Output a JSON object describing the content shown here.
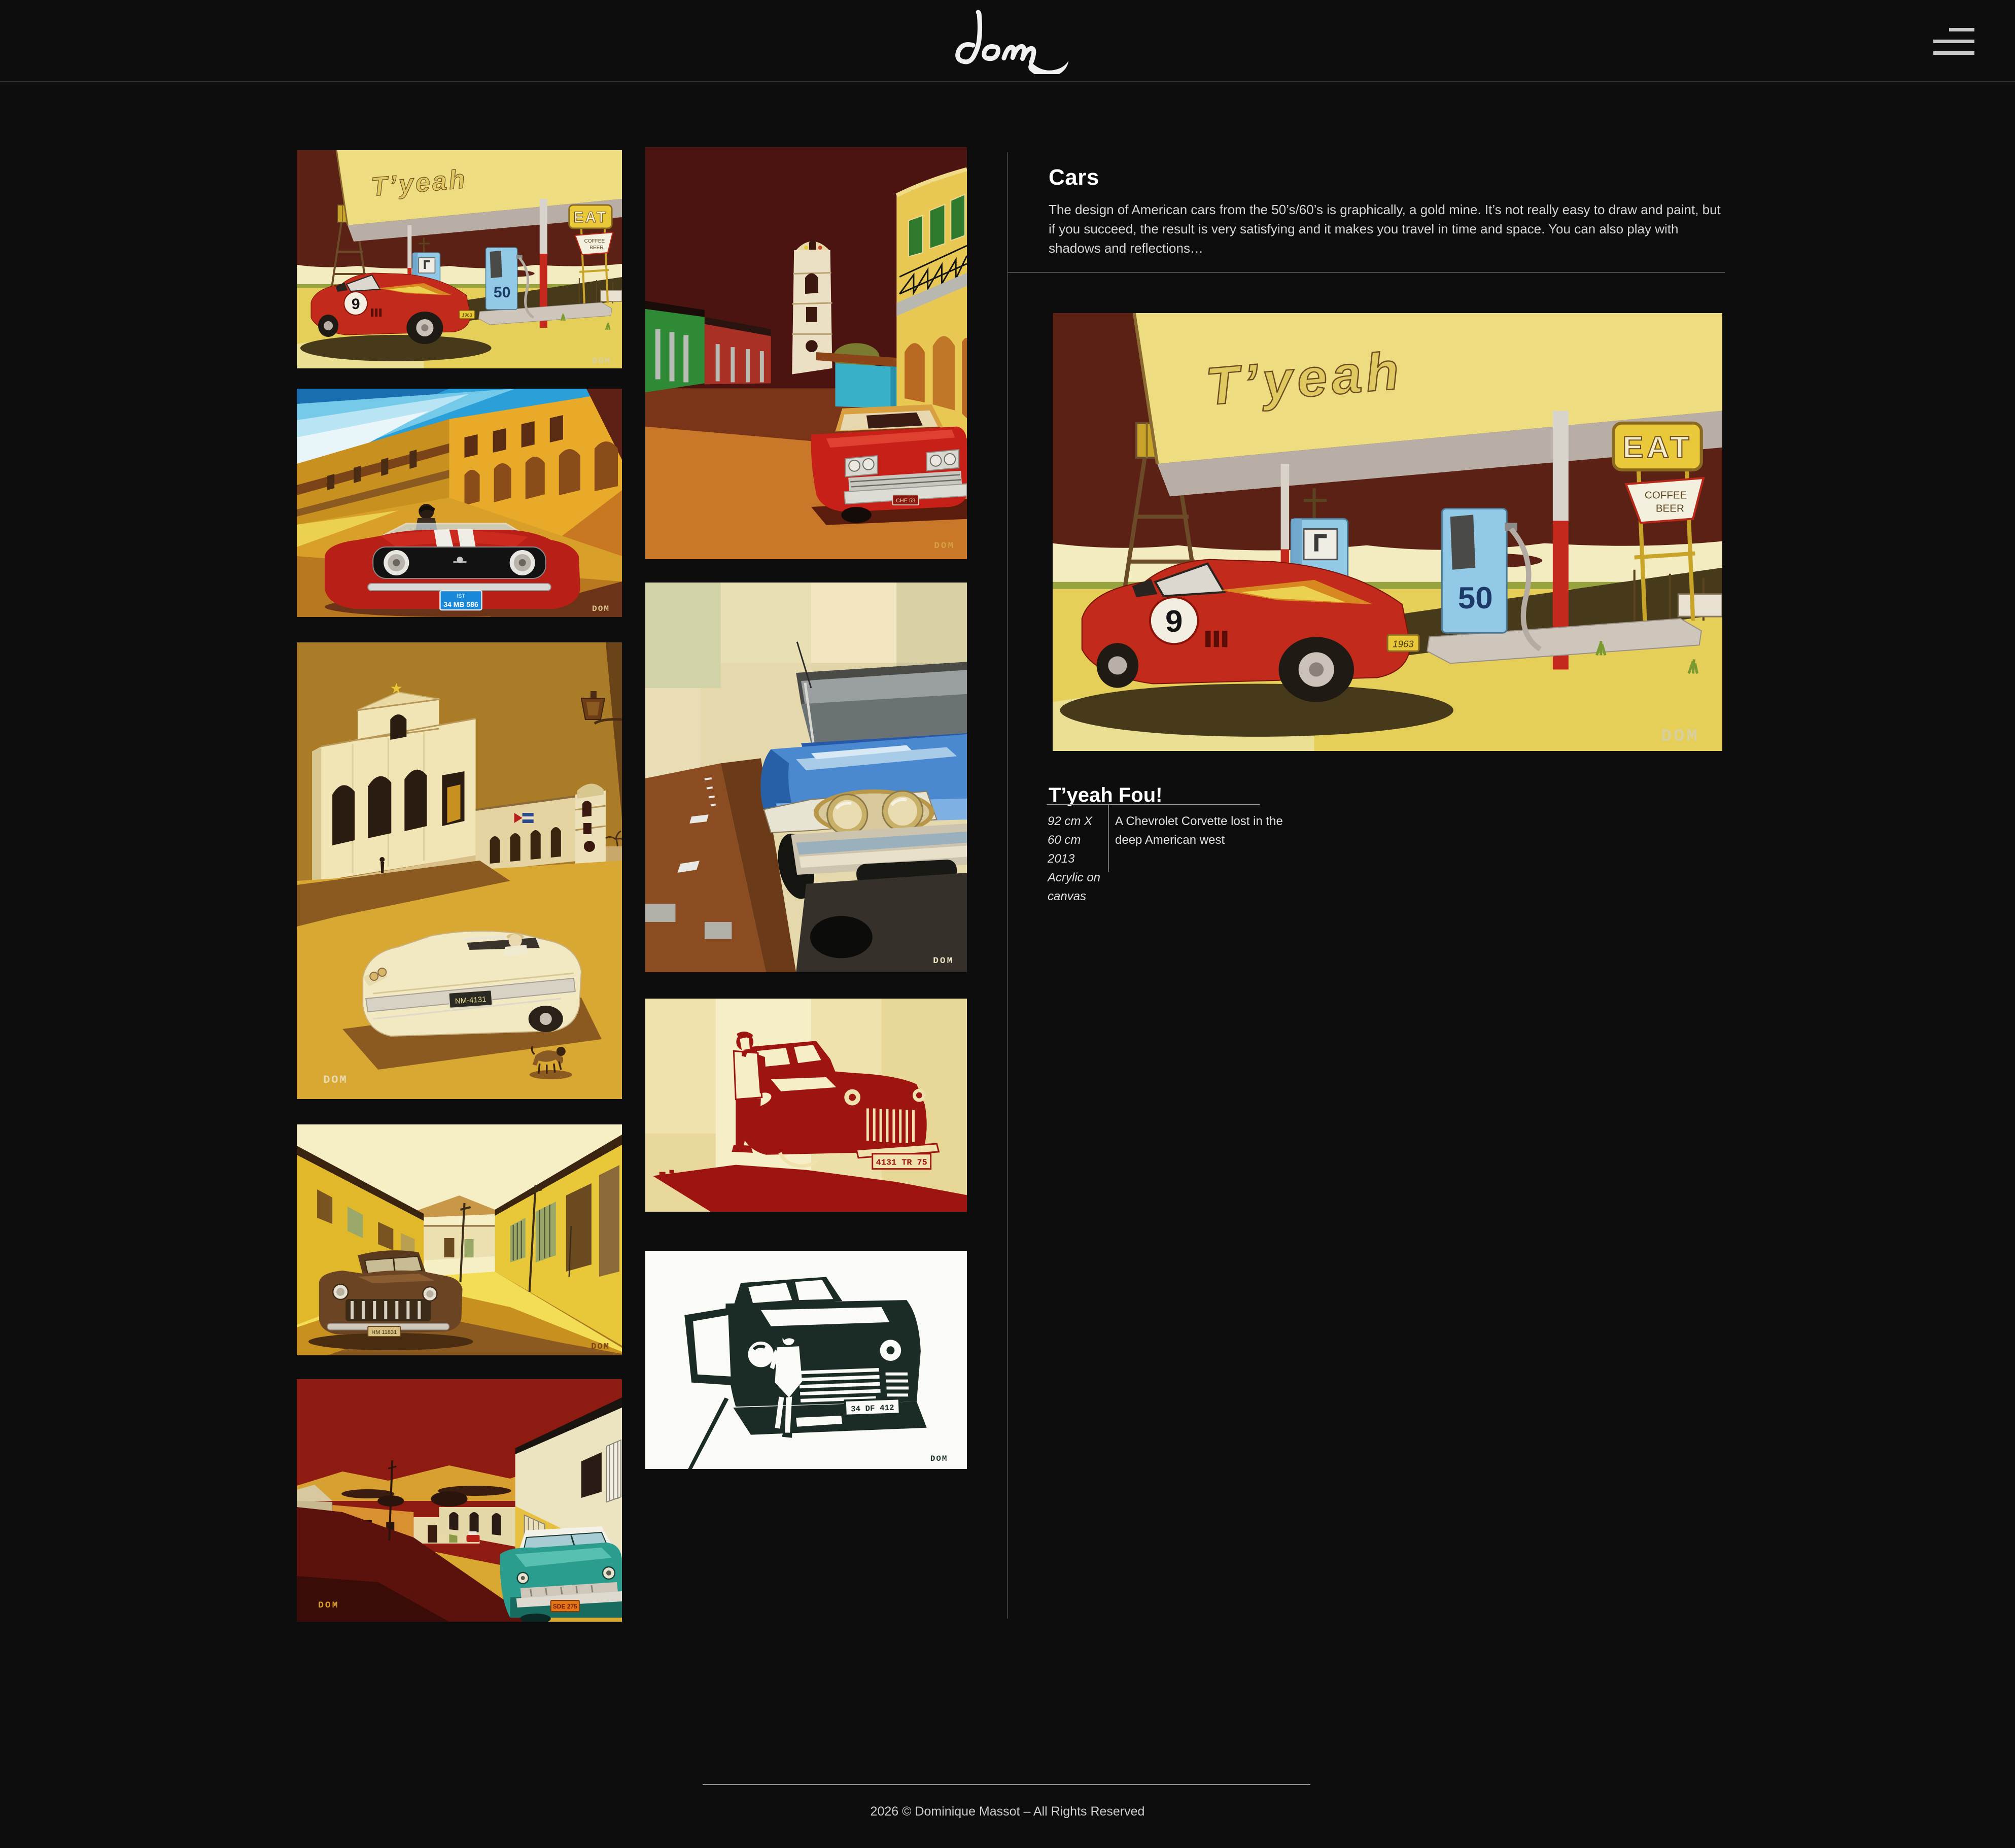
{
  "header": {
    "logo": "dom"
  },
  "panel": {
    "heading": "Cars",
    "description": "The design of American cars from the 50’s/60’s is graphically, a gold mine. It’s not really easy to draw and paint, but if you succeed, the result is very satisfying and it makes you travel in time and space. You can also play with shadows and reflections…",
    "artwork": {
      "title": "T’yeah Fou!",
      "size": "92 cm X 60 cm",
      "year": "2013",
      "medium": "Acrylic on canvas",
      "caption": "A Chevrolet Corvette lost in the deep American west"
    }
  },
  "paintings": {
    "gas": {
      "banner": "T’yeah",
      "pump_left": "NOV",
      "pump_right": "50",
      "sign_eat": "EAT",
      "sign_coffee": "COFFEE",
      "sign_beer": "BEER",
      "race_number": "9",
      "plate": "1963",
      "sig": "DOM"
    },
    "mustang": {
      "plate_top": "IST",
      "plate": "34 MB 586",
      "sig": "DOM"
    },
    "church": {
      "plate": "NM-4131",
      "sig": "DOM"
    },
    "ystreet": {
      "plate": "HM 11831",
      "sig": "DOM"
    },
    "rstreet": {
      "plate": "SDE 275",
      "sig": "DOM"
    },
    "trinidad": {
      "plate": "CHE 58",
      "sig": "DOM"
    },
    "blue": {
      "sig": "DOM"
    },
    "rsten": {
      "plate": "4131 TR 75",
      "sig": "DOM"
    },
    "bwsten": {
      "plate": "34 DF 412",
      "sig": "DOM"
    }
  },
  "footer": {
    "copyright": "2026 © Dominique Massot – All Rights Reserved"
  }
}
